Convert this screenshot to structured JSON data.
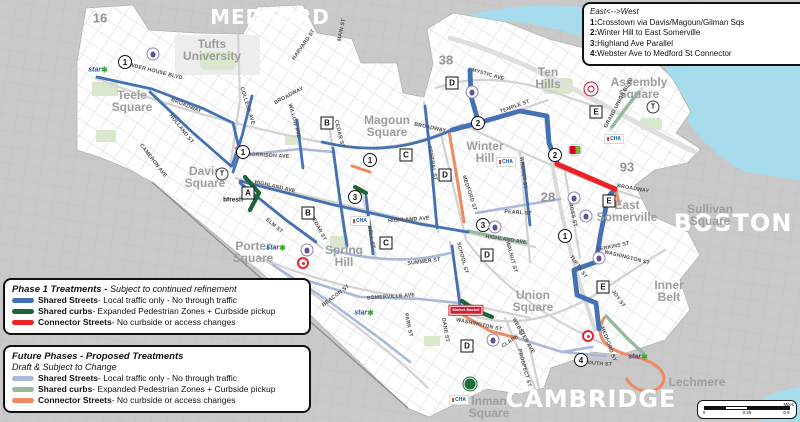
{
  "colors": {
    "phase1": {
      "shared_streets": "#4470b4",
      "shared_curbs": "#1b6634",
      "connector": "#ec2227"
    },
    "future": {
      "shared_streets": "#a9b9d9",
      "shared_curbs": "#95ba9c",
      "connector": "#ef8960"
    },
    "water": "#a6dcec",
    "land_outside": "#c9c9c9",
    "land_somerville": "#ffffff",
    "park": "#d9e7cc"
  },
  "legend_routes": {
    "title": "East<-->West",
    "items": [
      {
        "num": "1:",
        "label": "Crosstown via Davis/Magoun/Gilman Sqs"
      },
      {
        "num": "2:",
        "label": "Winter Hill to East Somerville"
      },
      {
        "num": "3:",
        "label": "Highland Ave Parallel"
      },
      {
        "num": "4:",
        "label": "Webster Ave to Medford St Connector"
      }
    ]
  },
  "legend_phase1": {
    "palette": "phase1",
    "title": "Phase 1 Treatments - ",
    "subtitle": "Subject to continued refinement",
    "items": [
      {
        "key": "shared_streets",
        "name": "Shared Streets",
        "desc": " - Local traffic only - No through traffic"
      },
      {
        "key": "shared_curbs",
        "name": "Shared curbs",
        "desc": " - Expanded Pedestrian Zones + Curbside pickup"
      },
      {
        "key": "connector",
        "name": "Connector Streets",
        "desc": " - No curbside or access changes"
      }
    ]
  },
  "legend_future": {
    "palette": "future",
    "title": "Future Phases - Proposed Treatments",
    "subtitle": "Draft & Subject to Change",
    "items": [
      {
        "key": "shared_streets",
        "name": "Shared Streets",
        "desc": " - Local traffic only - No through traffic"
      },
      {
        "key": "shared_curbs",
        "name": "Shared curbs",
        "desc": " - Expanded Pedestrian Zones + Curbside pickup"
      },
      {
        "key": "connector",
        "name": "Connector Streets",
        "desc": " - No curbside or access changes"
      }
    ]
  },
  "scale_bar": {
    "ticks": [
      {
        "v": "0",
        "p": 0
      },
      {
        "v": "0.25",
        "p": 50
      },
      {
        "v": "0.5",
        "p": 96
      }
    ],
    "unit": "Miles"
  },
  "map": {
    "city_labels": [
      {
        "text": "MEDFORD",
        "x": 270,
        "y": 17,
        "size": 20
      },
      {
        "text": "BOSTON",
        "x": 733,
        "y": 223,
        "size": 24
      },
      {
        "text": "CAMBRIDGE",
        "x": 591,
        "y": 399,
        "size": 24
      }
    ],
    "area_labels": [
      {
        "lines": [
          "Tufts",
          "University"
        ],
        "x": 212,
        "y": 50
      },
      {
        "lines": [
          "Teele",
          "Square"
        ],
        "x": 132,
        "y": 101
      },
      {
        "lines": [
          "Davis",
          "Square"
        ],
        "x": 205,
        "y": 177
      },
      {
        "lines": [
          "Magoun",
          "Square"
        ],
        "x": 387,
        "y": 126
      },
      {
        "lines": [
          "Winter",
          "Hill"
        ],
        "x": 485,
        "y": 152
      },
      {
        "lines": [
          "Ten",
          "Hills"
        ],
        "x": 548,
        "y": 78
      },
      {
        "lines": [
          "Assembly",
          "Square"
        ],
        "x": 639,
        "y": 88
      },
      {
        "lines": [
          "East",
          "Somerville"
        ],
        "x": 627,
        "y": 211
      },
      {
        "lines": [
          "Sullivan",
          "Square"
        ],
        "x": 710,
        "y": 215
      },
      {
        "lines": [
          "Inner",
          "Belt"
        ],
        "x": 669,
        "y": 291
      },
      {
        "lines": [
          "Union",
          "Square"
        ],
        "x": 533,
        "y": 301
      },
      {
        "lines": [
          "Porter",
          "Square"
        ],
        "x": 253,
        "y": 252
      },
      {
        "lines": [
          "Spring",
          "Hill"
        ],
        "x": 344,
        "y": 256
      },
      {
        "lines": [
          "Inman",
          "Square"
        ],
        "x": 489,
        "y": 407
      },
      {
        "lines": [
          "Lechmere"
        ],
        "x": 697,
        "y": 382
      }
    ],
    "street_labels": [
      {
        "t": "POWDER HOUSE BLVD",
        "x": 152,
        "y": 71,
        "r": 14
      },
      {
        "t": "BROADWAY",
        "x": 186,
        "y": 106,
        "r": 22
      },
      {
        "t": "BROADWAY",
        "x": 289,
        "y": 96,
        "r": -28
      },
      {
        "t": "BROADWAY",
        "x": 430,
        "y": 128,
        "r": 12
      },
      {
        "t": "BROADWAY",
        "x": 633,
        "y": 189,
        "r": 10
      },
      {
        "t": "HOLLAND ST",
        "x": 181,
        "y": 129,
        "r": 52
      },
      {
        "t": "COLLEGE AVE",
        "x": 247,
        "y": 106,
        "r": 73
      },
      {
        "t": "HARVARD ST",
        "x": 304,
        "y": 45,
        "r": -55
      },
      {
        "t": "MAIN ST",
        "x": 342,
        "y": 30,
        "r": -78
      },
      {
        "t": "CAMERON AVE",
        "x": 153,
        "y": 161,
        "r": 52
      },
      {
        "t": "WILLOW AVE",
        "x": 294,
        "y": 121,
        "r": 75
      },
      {
        "t": "CEDAR ST",
        "x": 339,
        "y": 134,
        "r": 76
      },
      {
        "t": "CEDAR ST",
        "x": 318,
        "y": 228,
        "r": 62
      },
      {
        "t": "ELM ST",
        "x": 274,
        "y": 226,
        "r": 40
      },
      {
        "t": "MORRISON AVE",
        "x": 268,
        "y": 156,
        "r": 3
      },
      {
        "t": "HIGHLAND AVE",
        "x": 275,
        "y": 187,
        "r": 13
      },
      {
        "t": "HIGHLAND AVE",
        "x": 409,
        "y": 220,
        "r": -4
      },
      {
        "t": "HIGHLAND AVE",
        "x": 506,
        "y": 240,
        "r": 8
      },
      {
        "t": "MYSTIC AVE",
        "x": 488,
        "y": 75,
        "r": 16
      },
      {
        "t": "TEMPLE ST",
        "x": 515,
        "y": 107,
        "r": -20
      },
      {
        "t": "CENTRAL ST",
        "x": 432,
        "y": 163,
        "r": 80
      },
      {
        "t": "MEDFORD ST",
        "x": 469,
        "y": 193,
        "r": 72
      },
      {
        "t": "MEDFORD ST",
        "x": 608,
        "y": 344,
        "r": 70
      },
      {
        "t": "WALNUT ST",
        "x": 523,
        "y": 173,
        "r": 83
      },
      {
        "t": "WALNUT ST",
        "x": 511,
        "y": 257,
        "r": 75
      },
      {
        "t": "PEARL ST",
        "x": 518,
        "y": 213,
        "r": 4
      },
      {
        "t": "CROSS ST",
        "x": 572,
        "y": 213,
        "r": 78
      },
      {
        "t": "TUFTS ST",
        "x": 578,
        "y": 267,
        "r": 55
      },
      {
        "t": "WASHINGTON ST",
        "x": 627,
        "y": 258,
        "r": 14
      },
      {
        "t": "WASHINGTON ST",
        "x": 479,
        "y": 325,
        "r": 12
      },
      {
        "t": "JOY ST",
        "x": 618,
        "y": 299,
        "r": 55
      },
      {
        "t": "SUMMER ST",
        "x": 424,
        "y": 262,
        "r": -7
      },
      {
        "t": "SCHOOL ST",
        "x": 462,
        "y": 258,
        "r": 75
      },
      {
        "t": "LOWELL ST",
        "x": 370,
        "y": 233,
        "r": 80
      },
      {
        "t": "SOMERVILLE AVE",
        "x": 391,
        "y": 297,
        "r": -4
      },
      {
        "t": "BEACON ST",
        "x": 336,
        "y": 296,
        "r": -38
      },
      {
        "t": "PARK ST",
        "x": 408,
        "y": 325,
        "r": 78
      },
      {
        "t": "DANE ST",
        "x": 445,
        "y": 330,
        "r": 80
      },
      {
        "t": "WEBSTER AVE",
        "x": 523,
        "y": 336,
        "r": 60
      },
      {
        "t": "PROSPECT ST",
        "x": 524,
        "y": 368,
        "r": 75
      },
      {
        "t": "GRAND UNION BLVD",
        "x": 619,
        "y": 103,
        "r": -62
      },
      {
        "t": "PERKINS ST",
        "x": 613,
        "y": 247,
        "r": -12
      },
      {
        "t": "CLARK ST",
        "x": 514,
        "y": 339,
        "r": -35
      },
      {
        "t": "SOUTH ST",
        "x": 598,
        "y": 364,
        "r": 4
      }
    ],
    "route_number_markers": [
      {
        "n": "1",
        "x": 125,
        "y": 62
      },
      {
        "n": "1",
        "x": 243,
        "y": 152
      },
      {
        "n": "1",
        "x": 370,
        "y": 160
      },
      {
        "n": "3",
        "x": 355,
        "y": 197
      },
      {
        "n": "3",
        "x": 483,
        "y": 225
      },
      {
        "n": "1",
        "x": 565,
        "y": 236
      },
      {
        "n": "2",
        "x": 478,
        "y": 123
      },
      {
        "n": "2",
        "x": 555,
        "y": 155
      },
      {
        "n": "4",
        "x": 581,
        "y": 360
      }
    ],
    "segment_letter_markers": [
      {
        "l": "A",
        "x": 248,
        "y": 193
      },
      {
        "l": "B",
        "x": 327,
        "y": 123
      },
      {
        "l": "B",
        "x": 308,
        "y": 213
      },
      {
        "l": "C",
        "x": 406,
        "y": 155
      },
      {
        "l": "C",
        "x": 386,
        "y": 243
      },
      {
        "l": "D",
        "x": 452,
        "y": 83
      },
      {
        "l": "D",
        "x": 445,
        "y": 175
      },
      {
        "l": "D",
        "x": 487,
        "y": 255
      },
      {
        "l": "D",
        "x": 467,
        "y": 346
      },
      {
        "l": "E",
        "x": 596,
        "y": 112
      },
      {
        "l": "E",
        "x": 609,
        "y": 201
      },
      {
        "l": "E",
        "x": 603,
        "y": 287
      }
    ],
    "highway_shields": [
      {
        "text": "16",
        "x": 100,
        "y": 18
      },
      {
        "text": "38",
        "x": 446,
        "y": 60
      },
      {
        "text": "93",
        "x": 627,
        "y": 167
      },
      {
        "text": "28",
        "x": 548,
        "y": 197
      }
    ],
    "transit_stations": [
      {
        "label": "T",
        "x": 222,
        "y": 174
      },
      {
        "label": "T",
        "x": 653,
        "y": 107
      }
    ],
    "pois": [
      {
        "name": "star-market",
        "text": "star",
        "suffix": "✱",
        "x": 98,
        "y": 70
      },
      {
        "name": "star-market",
        "text": "star",
        "suffix": "✱",
        "x": 276,
        "y": 248
      },
      {
        "name": "star-market",
        "text": "star",
        "suffix": "✱",
        "x": 364,
        "y": 313
      },
      {
        "name": "star-market",
        "text": "star",
        "suffix": "✱",
        "x": 638,
        "y": 357
      },
      {
        "name": "bfresh",
        "text": "bfresh",
        "x": 233,
        "y": 200
      },
      {
        "name": "target",
        "x": 303,
        "y": 263
      },
      {
        "name": "target",
        "x": 588,
        "y": 336
      },
      {
        "name": "market-basket",
        "text": "Market Basket",
        "x": 466,
        "y": 310
      },
      {
        "name": "whole-foods",
        "x": 470,
        "y": 384
      },
      {
        "name": "trader-joes",
        "x": 591,
        "y": 89
      },
      {
        "name": "stop-and-shop",
        "x": 575,
        "y": 150
      },
      {
        "name": "cha-clinic",
        "text": "CHA",
        "x": 506,
        "y": 162
      },
      {
        "name": "cha-clinic",
        "text": "CHA",
        "x": 360,
        "y": 221
      },
      {
        "name": "cha-clinic",
        "text": "CHA",
        "x": 614,
        "y": 139
      },
      {
        "name": "cha-clinic",
        "text": "CHA",
        "x": 459,
        "y": 400
      },
      {
        "name": "school",
        "x": 153,
        "y": 54
      },
      {
        "name": "school",
        "x": 472,
        "y": 92
      },
      {
        "name": "school",
        "x": 307,
        "y": 250
      },
      {
        "name": "school",
        "x": 495,
        "y": 227
      },
      {
        "name": "school",
        "x": 574,
        "y": 198
      },
      {
        "name": "school",
        "x": 586,
        "y": 216
      },
      {
        "name": "school",
        "x": 599,
        "y": 258
      },
      {
        "name": "school",
        "x": 493,
        "y": 340
      },
      {
        "name": "community-org",
        "x": 598,
        "y": 174
      }
    ]
  }
}
